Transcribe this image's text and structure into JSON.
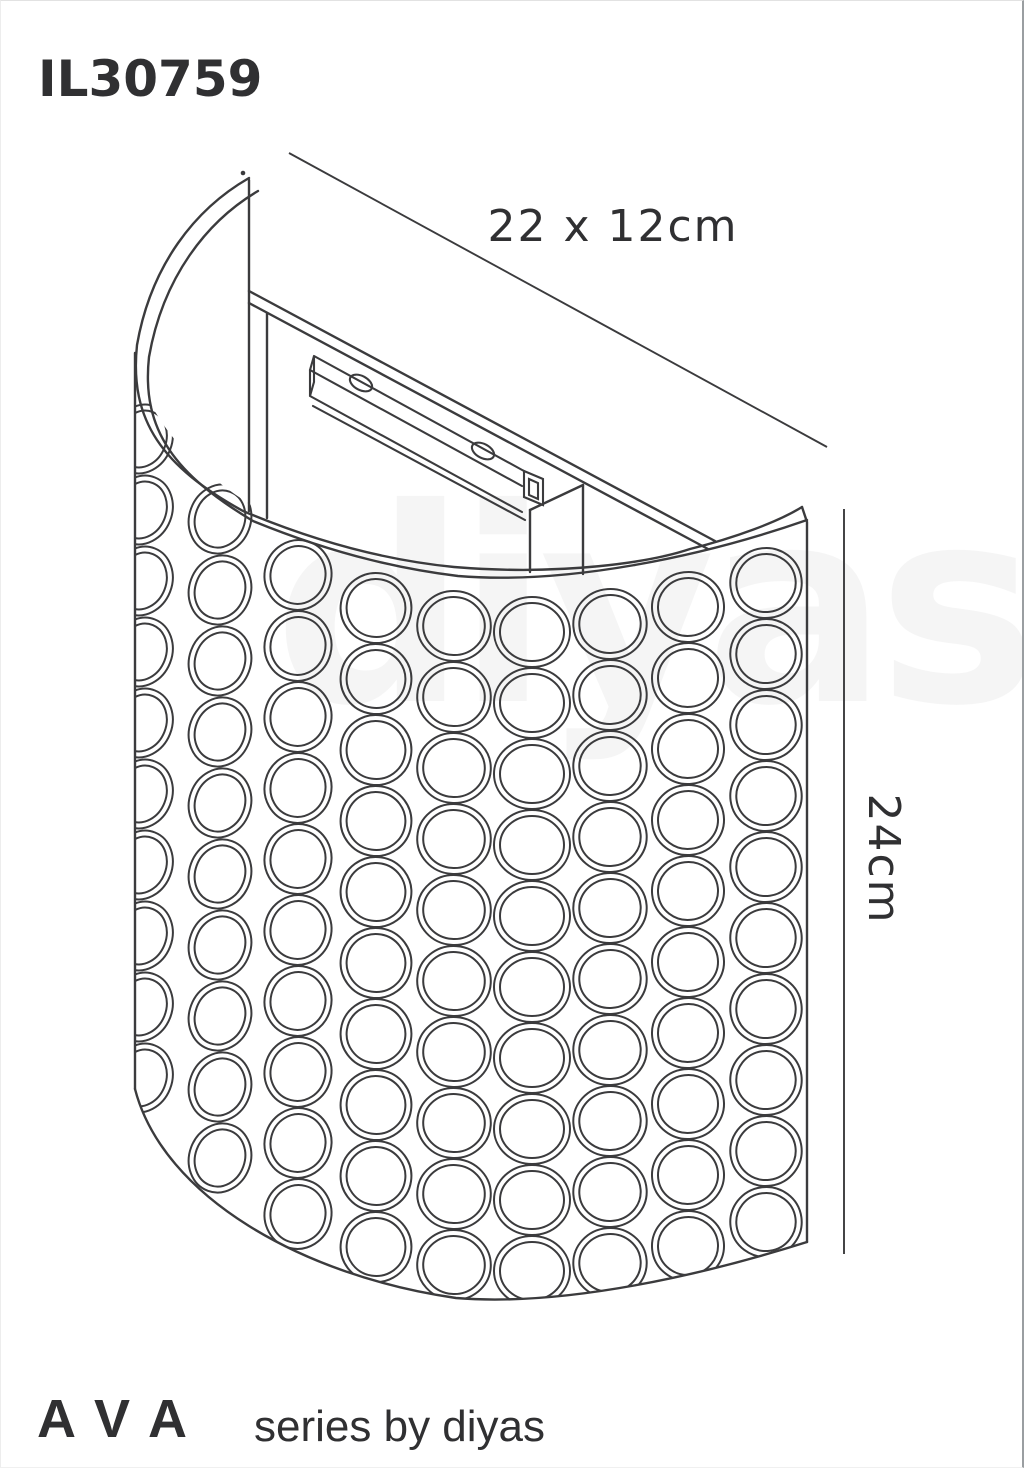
{
  "product": {
    "code": "IL30759"
  },
  "dimensions": {
    "width_depth_label": "22 x 12cm",
    "height_label": "24cm"
  },
  "branding": {
    "series_name": "AVA",
    "series_caption": "series by diyas",
    "watermark": "diyas"
  },
  "drawing": {
    "subject": "curved-crystal-wall-light",
    "elements": [
      "back-panel",
      "mounting-bracket",
      "screw-holes",
      "square-tube-end",
      "crystal-ring-shade"
    ]
  },
  "colors": {
    "ink": "#3b3b3d",
    "text": "#303032",
    "watermark": "#000000"
  }
}
